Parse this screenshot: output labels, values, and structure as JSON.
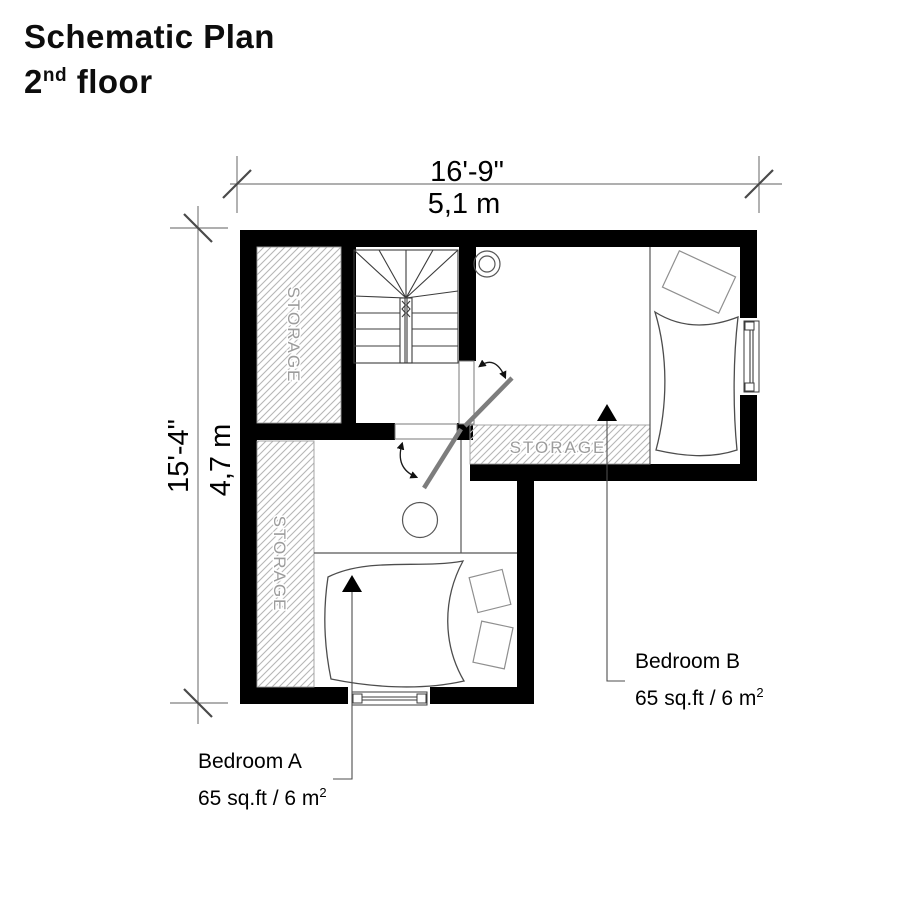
{
  "title": {
    "line1": "Schematic Plan",
    "line2_num": "2",
    "line2_sup": "nd",
    "line2_rest": " floor"
  },
  "dimensions": {
    "top": {
      "imperial": "16'-9\"",
      "metric": "5,1 m"
    },
    "left": {
      "imperial": "15'-4\"",
      "metric": "4,7 m"
    }
  },
  "rooms": {
    "bedroom_a": {
      "name": "Bedroom A",
      "area": "65 sq.ft / 6 m",
      "area_sup": "2"
    },
    "bedroom_b": {
      "name": "Bedroom B",
      "area": "65 sq.ft / 6 m",
      "area_sup": "2"
    }
  },
  "storage_labels": {
    "upper_left": "STORAGE",
    "lower_left": "STORAGE",
    "bedroom_b": "STORAGE"
  },
  "colors": {
    "wall": "#000000",
    "hatch_line": "#b6b6b6",
    "storage_text": "#9c9c9c",
    "dimension_line": "#7f7f7f",
    "tick": "#4a4a4a",
    "text": "#000000",
    "door_leaf": "#7d7d7d"
  }
}
